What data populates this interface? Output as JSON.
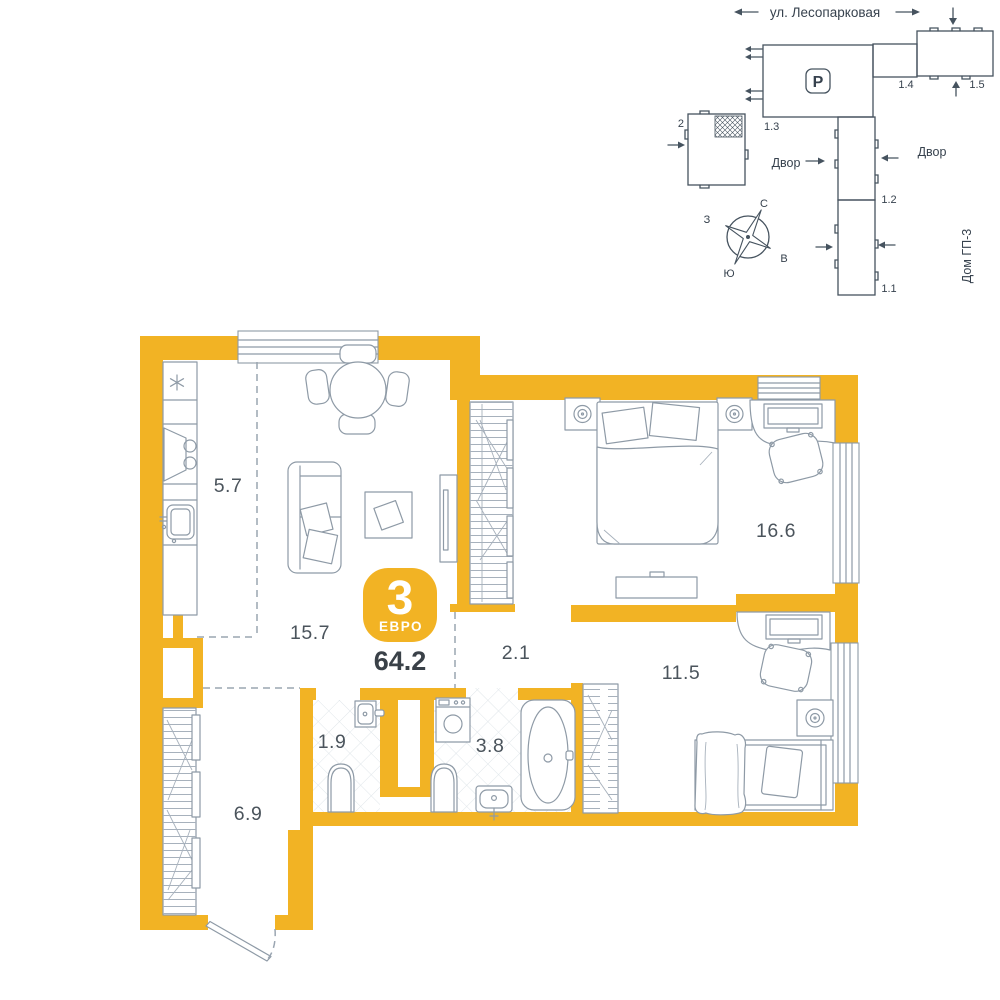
{
  "site_plan": {
    "street": "ул. Лесопарковая",
    "parking_label": "P",
    "yard_left": "Двор",
    "yard_right": "Двор",
    "neighbor_house": "Дом ГП-3",
    "buildings": {
      "b1_1": "1.1",
      "b1_2": "1.2",
      "b1_3": "1.3",
      "b1_4": "1.4",
      "b1_5": "1.5",
      "b2": "2"
    },
    "compass": {
      "north": "С",
      "east": "В",
      "south": "Ю",
      "west": "З"
    }
  },
  "apartment": {
    "badge_rooms": "3",
    "badge_type": "ЕВРО",
    "total_area": "64.2",
    "areas": {
      "kitchen": "5.7",
      "living_room": "15.7",
      "bedroom_main": "16.6",
      "bedroom_second": "11.5",
      "corridor": "2.1",
      "wc": "1.9",
      "bathroom": "3.8",
      "hallway": "6.9"
    }
  },
  "colors": {
    "wall_accent": "#F2B324",
    "furniture_line": "#8E9AA6",
    "site_line": "#46535F",
    "label_text": "#4B545C"
  }
}
